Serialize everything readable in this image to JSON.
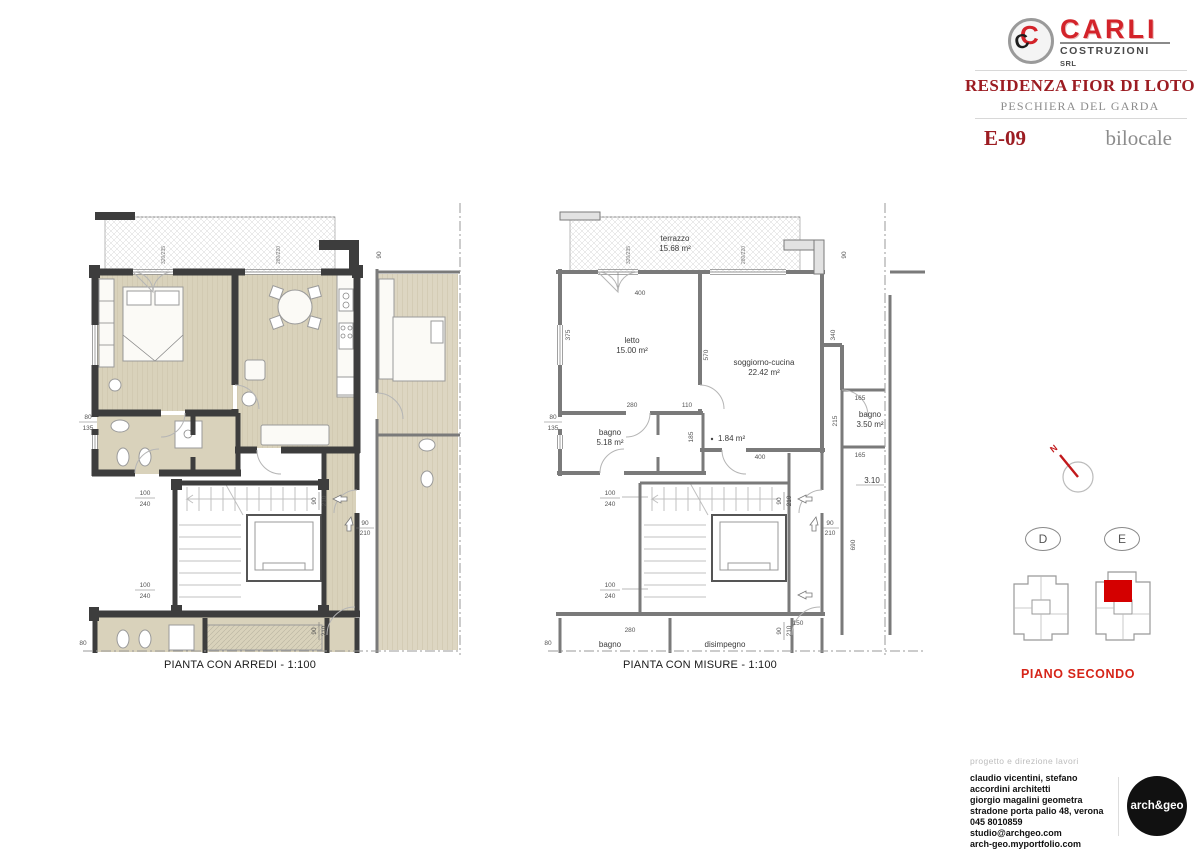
{
  "header": {
    "logo": {
      "brand": "CARLI",
      "sub": "COSTRUZIONI",
      "legal": "SRL",
      "mark_red": "C",
      "mark_black": "C"
    },
    "project_title": "RESIDENZA FIOR DI LOTO",
    "location": "PESCHIERA DEL GARDA",
    "unit_code": "E-09",
    "unit_type": "bilocale"
  },
  "plans": {
    "arredi": {
      "caption": "PIANTA CON ARREDI - 1:100",
      "dims": {
        "d80": "80",
        "d90v": "90",
        "w1": "320/235",
        "w2": "280/220"
      },
      "stk": [
        [
          "80",
          "135"
        ],
        [
          "100",
          "240"
        ],
        [
          "100",
          "240"
        ],
        [
          "90",
          "210"
        ],
        [
          "90",
          "210"
        ],
        [
          "90",
          "210"
        ]
      ]
    },
    "misure": {
      "caption": "PIANTA CON MISURE - 1:100",
      "rooms": {
        "terrazzo": {
          "name": "terrazzo",
          "area": "15.68 m²"
        },
        "letto": {
          "name": "letto",
          "area": "15.00 m²"
        },
        "soggiorno": {
          "name": "soggiorno-cucina",
          "area": "22.42 m²"
        },
        "bagno1": {
          "name": "bagno",
          "area": "5.18 m²"
        },
        "antibagno": {
          "area": "1.84 m²"
        },
        "bagno2": {
          "name": "bagno",
          "area": "3.50 m²"
        },
        "bagno3": {
          "name": "bagno"
        },
        "disimpegno": {
          "name": "disimpegno"
        }
      },
      "level_mark": "3.10",
      "dims": {
        "top_window": "400",
        "letto_w": "280",
        "corr": "110",
        "corr_h": "185",
        "letto_h": "375",
        "sogg_h": "570",
        "sogg_w": "400",
        "right1": "340",
        "right2": "690",
        "bagno2_h": "215",
        "a165": "165",
        "b165": "165",
        "bottom_w": "280",
        "bottom_r": "150",
        "d80": "80",
        "d90v": "90",
        "w1": "320/235",
        "w2": "280/220"
      },
      "stk": [
        [
          "80",
          "135"
        ],
        [
          "100",
          "240"
        ],
        [
          "100",
          "240"
        ],
        [
          "90",
          "210"
        ],
        [
          "90",
          "210"
        ],
        [
          "90",
          "210"
        ]
      ]
    }
  },
  "key": {
    "north_label": "N",
    "block_d": "D",
    "block_e": "E",
    "floor_label": "PIANO SECONDO"
  },
  "footer": {
    "section_label": "progetto e direzione lavori",
    "lines": [
      "claudio vicentini, stefano accordini architetti",
      "giorgio magalini geometra",
      "stradone porta palio 48, verona",
      "045 8010859",
      "studio@archgeo.com",
      "arch-geo.myportfolio.com"
    ],
    "studio_logo": "arch&geo"
  },
  "colors": {
    "title_red": "#9c1c22",
    "logo_red": "#d3232a",
    "floor_red": "#d62418",
    "highlight_red": "#d40000",
    "wall_dark": "#3d3d3d",
    "floor_beige": "#d9d2bb",
    "text_gray": "#8c8c8c"
  }
}
